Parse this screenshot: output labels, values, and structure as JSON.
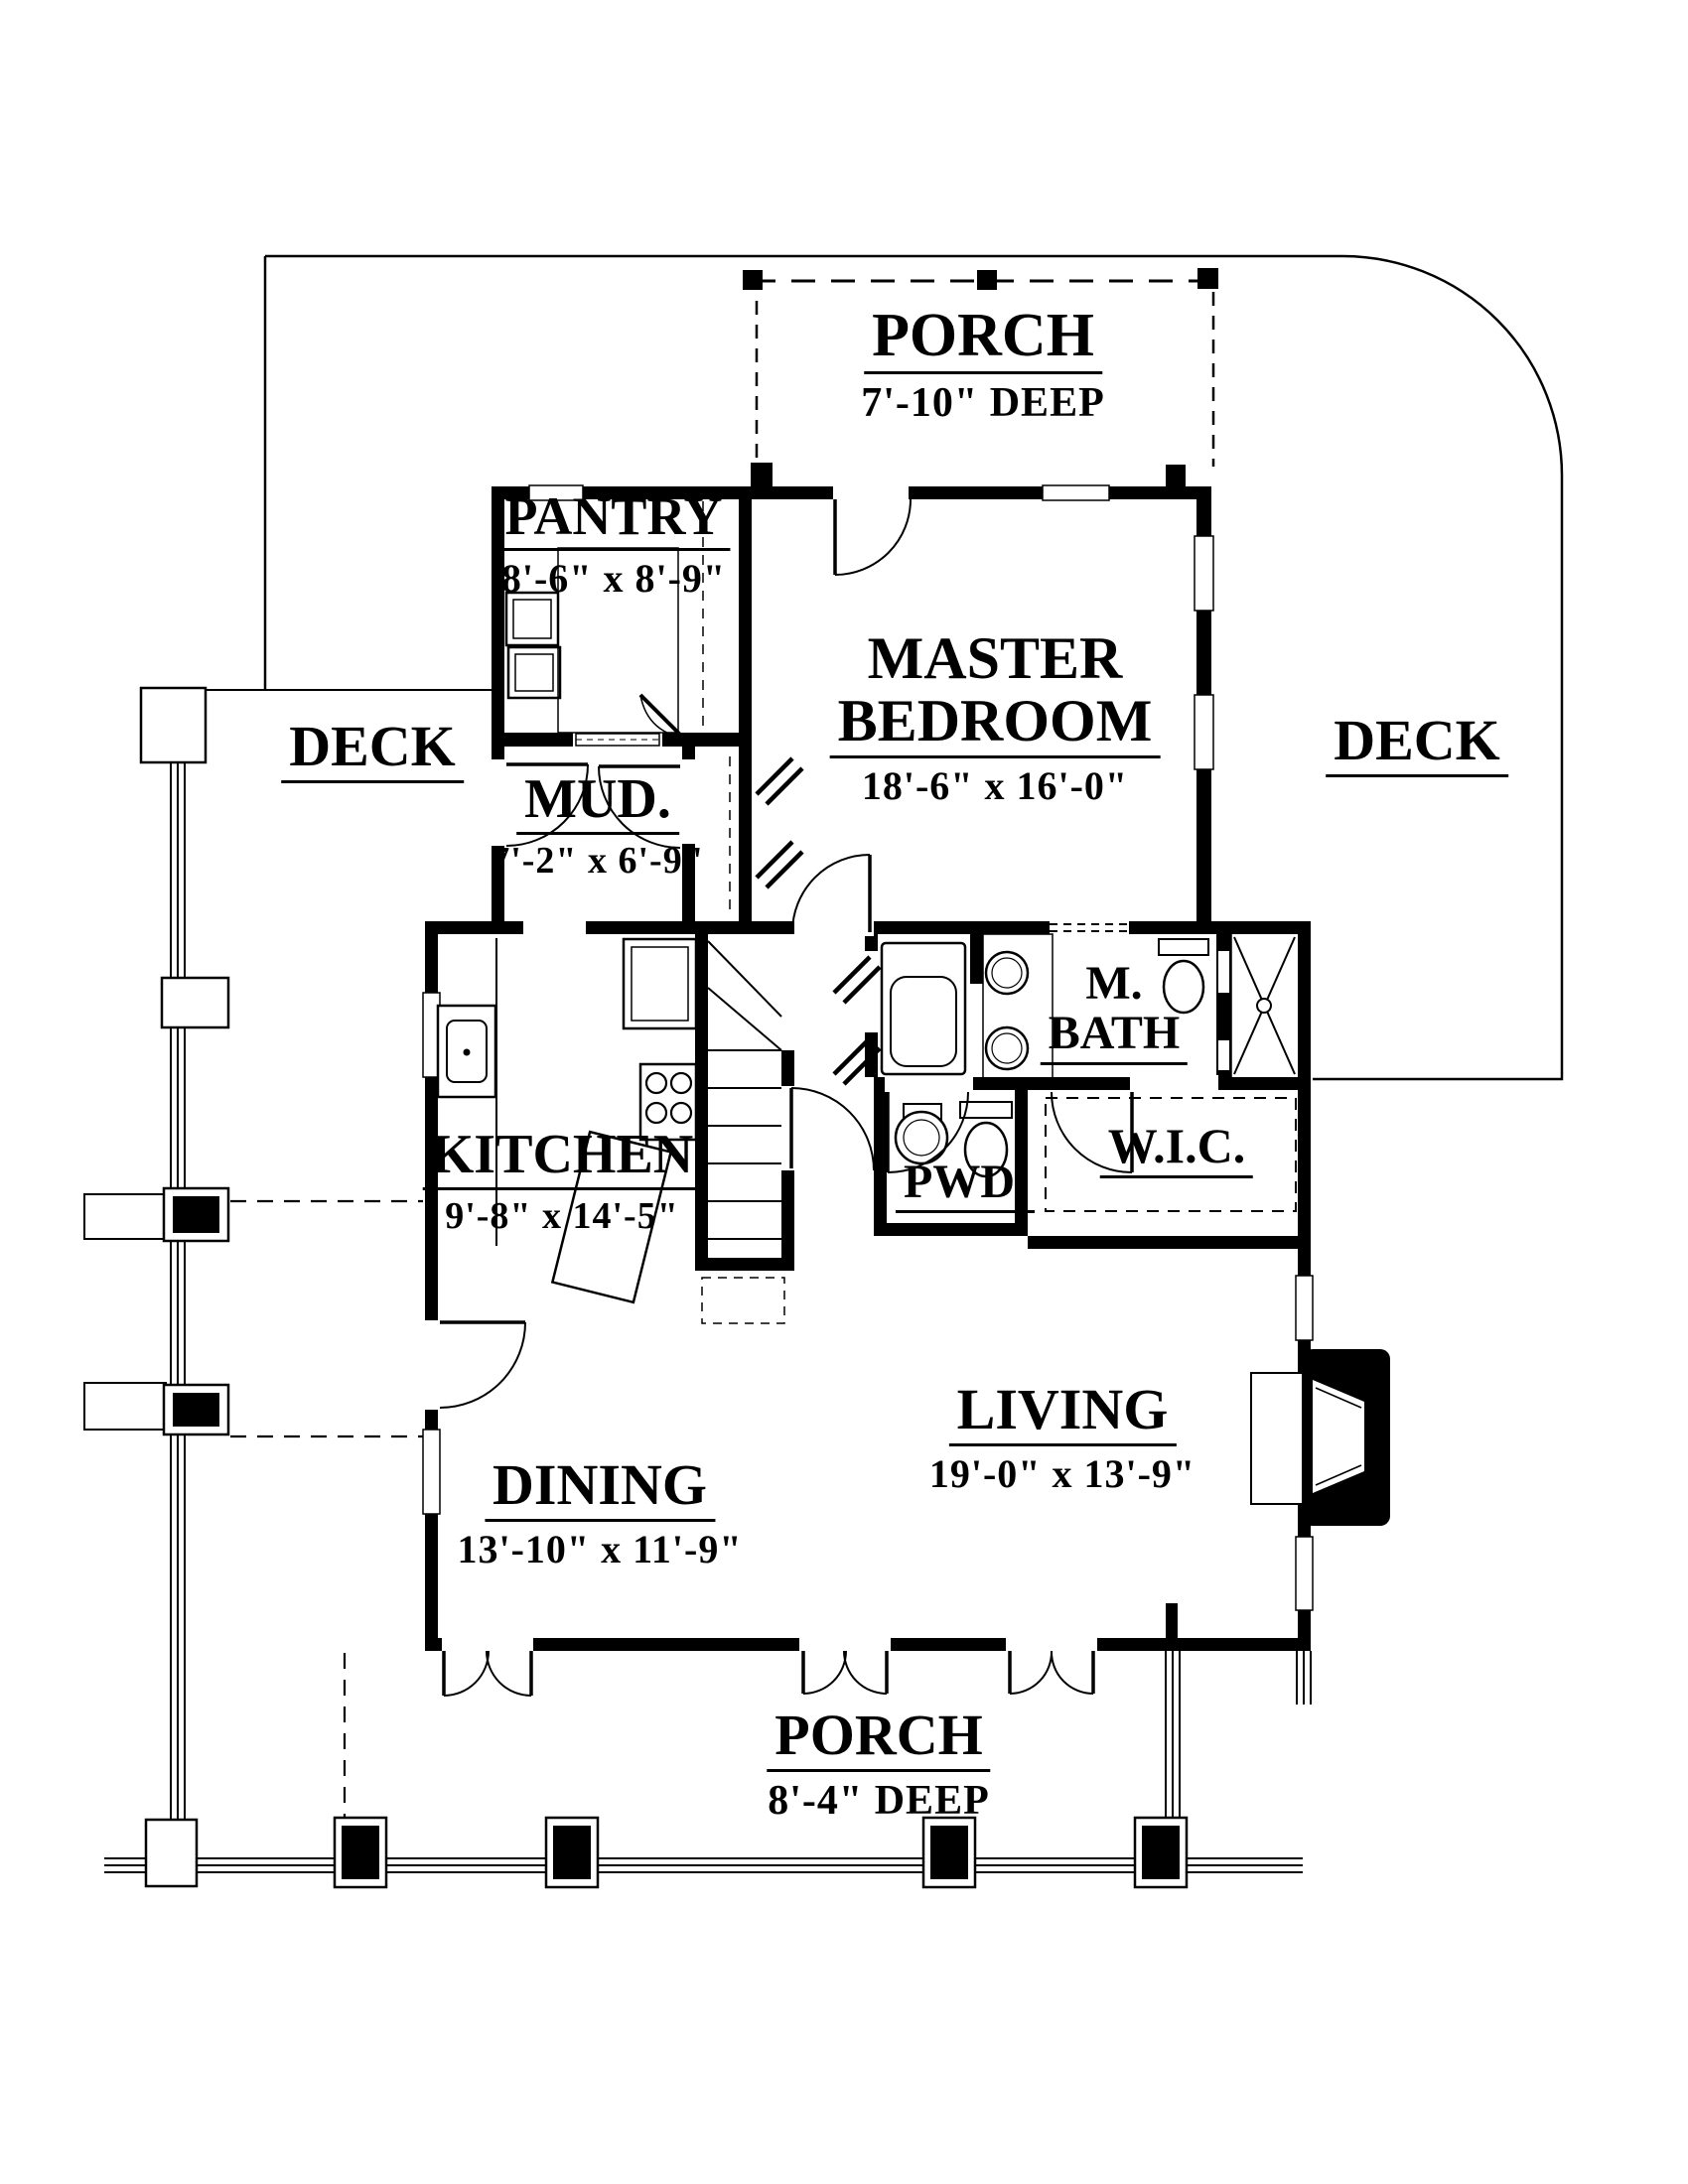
{
  "colors": {
    "ink": "#000000",
    "background": "#ffffff"
  },
  "labels": {
    "porch_top": {
      "name": "PORCH",
      "dim": "7'-10\" DEEP"
    },
    "pantry": {
      "name": "PANTRY",
      "dim": "8'-6\" x 8'-9\""
    },
    "master": {
      "name1": "MASTER",
      "name2": "BEDROOM",
      "dim": "18'-6\" x 16'-0\""
    },
    "deck_left": {
      "name": "DECK"
    },
    "deck_right": {
      "name": "DECK"
    },
    "mud": {
      "name": "MUD.",
      "dim": "7'-2\" x 6'-9\""
    },
    "kitchen": {
      "name": "KITCHEN",
      "dim": "9'-8\" x 14'-5\""
    },
    "master_bath": {
      "name1": "M.",
      "name2": "BATH"
    },
    "powder": {
      "name": "PWD."
    },
    "wic": {
      "name": "W.I.C."
    },
    "living": {
      "name": "LIVING",
      "dim": "19'-0\" x 13'-9\""
    },
    "dining": {
      "name": "DINING",
      "dim": "13'-10\" x 11'-9\""
    },
    "porch_bottom": {
      "name": "PORCH",
      "dim": "8'-4\" DEEP"
    }
  }
}
